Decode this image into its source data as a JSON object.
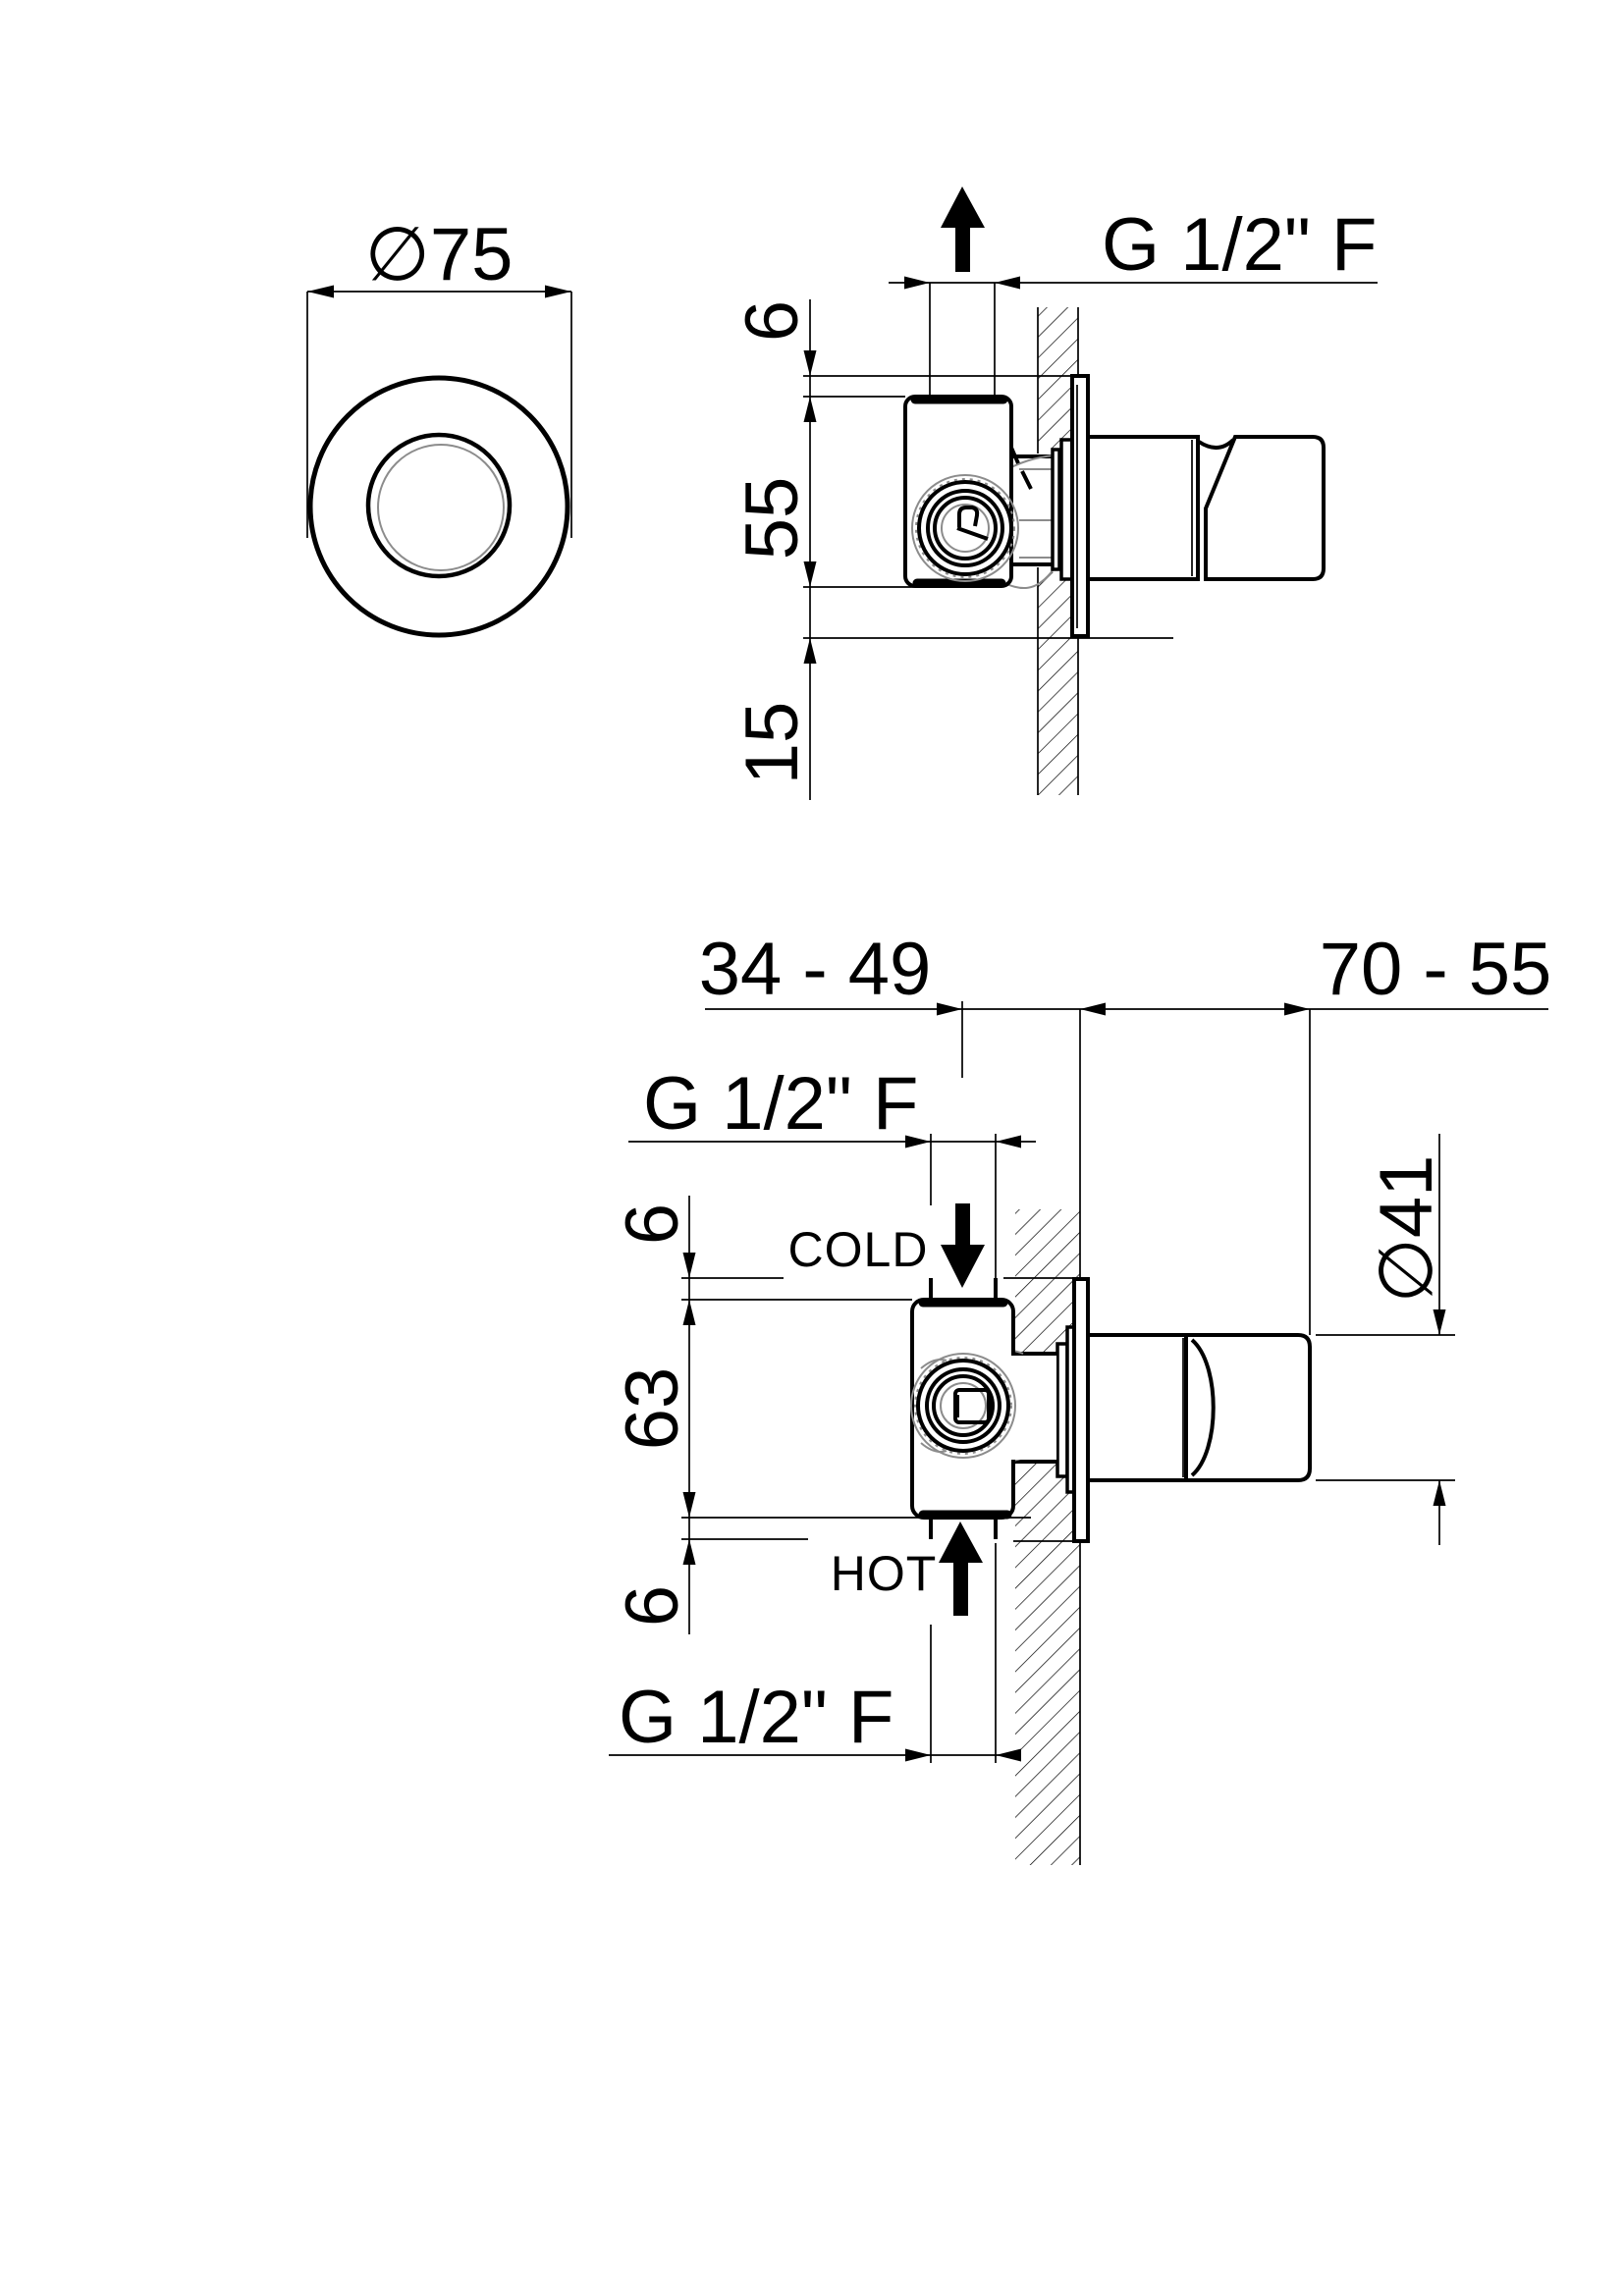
{
  "drawing": {
    "type": "technical-drawing",
    "background_color": "#ffffff",
    "line_color": "#000000",
    "aux_line_color": "#8c8c8c",
    "front_view": {
      "diameter_label": "∅75"
    },
    "side_view": {
      "port_label": "G 1/2\" F",
      "dim_top_offset": "6",
      "dim_body_height": "55",
      "dim_bottom_offset": "15"
    },
    "section_view": {
      "dim_depth_range": "34 - 49",
      "dim_protrusion_range": "70 - 55",
      "cold_port_label": "G 1/2\" F",
      "hot_port_label": "G 1/2\" F",
      "dim_top_offset": "6",
      "dim_body_height": "63",
      "dim_bottom_offset": "6",
      "handle_diameter_label": "∅41",
      "cold_label": "COLD",
      "hot_label": "HOT"
    }
  }
}
